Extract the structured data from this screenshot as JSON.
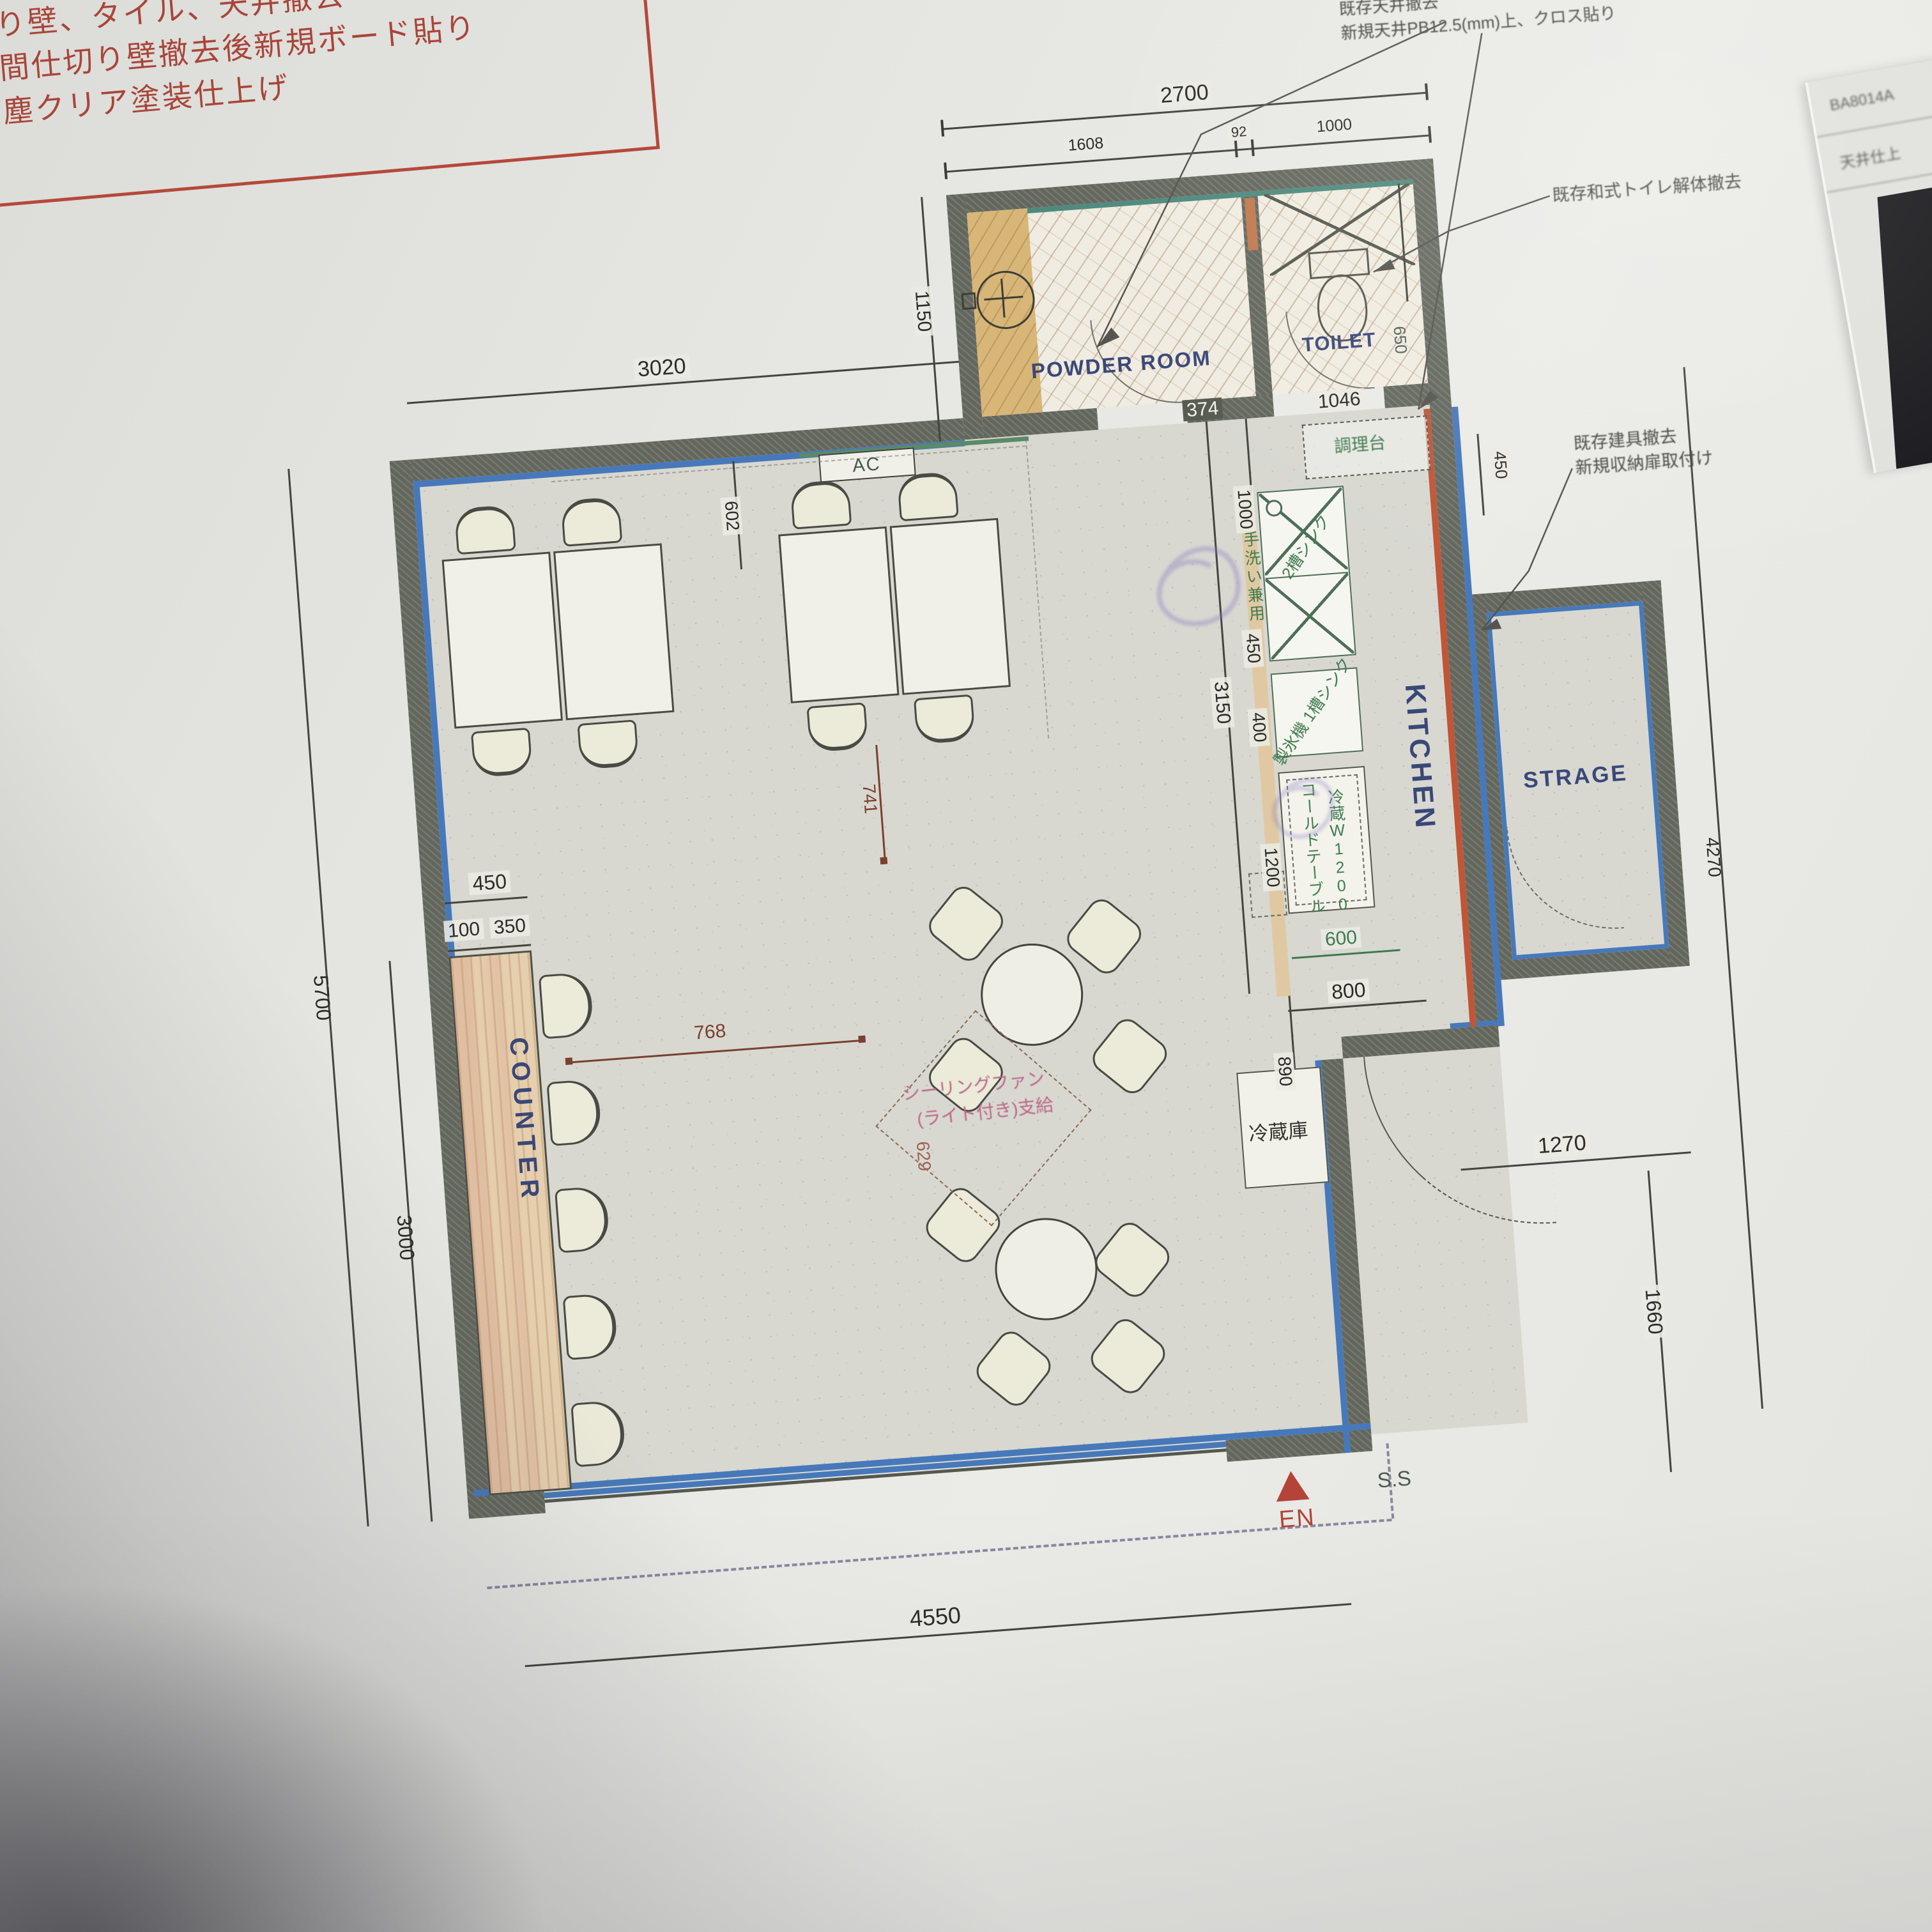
{
  "colors": {
    "accent_blue": "#4779ba",
    "wall_gray": "#62665c",
    "red_wall_line": "#bf5638",
    "navy_label": "#3a4878",
    "green_label": "#3f7a4e",
    "pink_note": "#bb6688",
    "red_note": "#b5483c"
  },
  "demolition_note": {
    "line1": "り壁、タイル、天井撤去",
    "line2": "間仕切り壁撤去後新規ボード貼り",
    "line3": "塵クリア塗装仕上げ"
  },
  "notes": {
    "ceiling_1": "既存天井撤去",
    "ceiling_2": "新規天井PB12.5(mm)上、クロス貼り",
    "toilet": "既存和式トイレ解体撤去",
    "storage_1": "既存建具撤去",
    "storage_2": "新規収納扉取付け",
    "fan_1": "シーリングファン",
    "fan_2": "(ライト付き)支給"
  },
  "rooms": {
    "powder": "POWDER ROOM",
    "toilet": "TOILET",
    "kitchen": "KITCHEN",
    "storage": "STRAGE",
    "counter": "COUNTER"
  },
  "equipment": {
    "ac": "AC",
    "prep_counter": "調理台",
    "hand_sink": "手洗い兼用",
    "double_sink": "2槽シンク",
    "ice_sink": "製氷機 1槽シンク",
    "cold_table_1": "コールドテーブル",
    "cold_table_2": "冷蔵W1200",
    "fridge": "冷蔵庫"
  },
  "markers": {
    "entrance": "EN",
    "ss": "S.S"
  },
  "corner_sheet": {
    "row1": "BA8014A",
    "row2": "天井仕上"
  },
  "dims": {
    "top_total": "2700",
    "top_powder": "1608",
    "top_gap": "92",
    "top_toilet": "1000",
    "powder_depth": "1150",
    "toilet_width": "650",
    "upper_left": "3020",
    "wall_inset": "602",
    "kitchen_a": "374",
    "kitchen_b": "1046",
    "kitchen_right": "450",
    "chain_1000": "1000",
    "chain_450": "450",
    "chain_400": "400",
    "chain_3150": "3150",
    "chain_1200": "1200",
    "chain_890": "890",
    "cold_600": "600",
    "cold_800": "800",
    "counter_450": "450",
    "counter_100": "100",
    "counter_350": "350",
    "left_5700": "5700",
    "left_3000": "3000",
    "fan_768": "768",
    "fan_741": "741",
    "fan_629": "629",
    "br_1270": "1270",
    "br_1660": "1660",
    "right_4270": "4270",
    "bottom_4550": "4550"
  }
}
